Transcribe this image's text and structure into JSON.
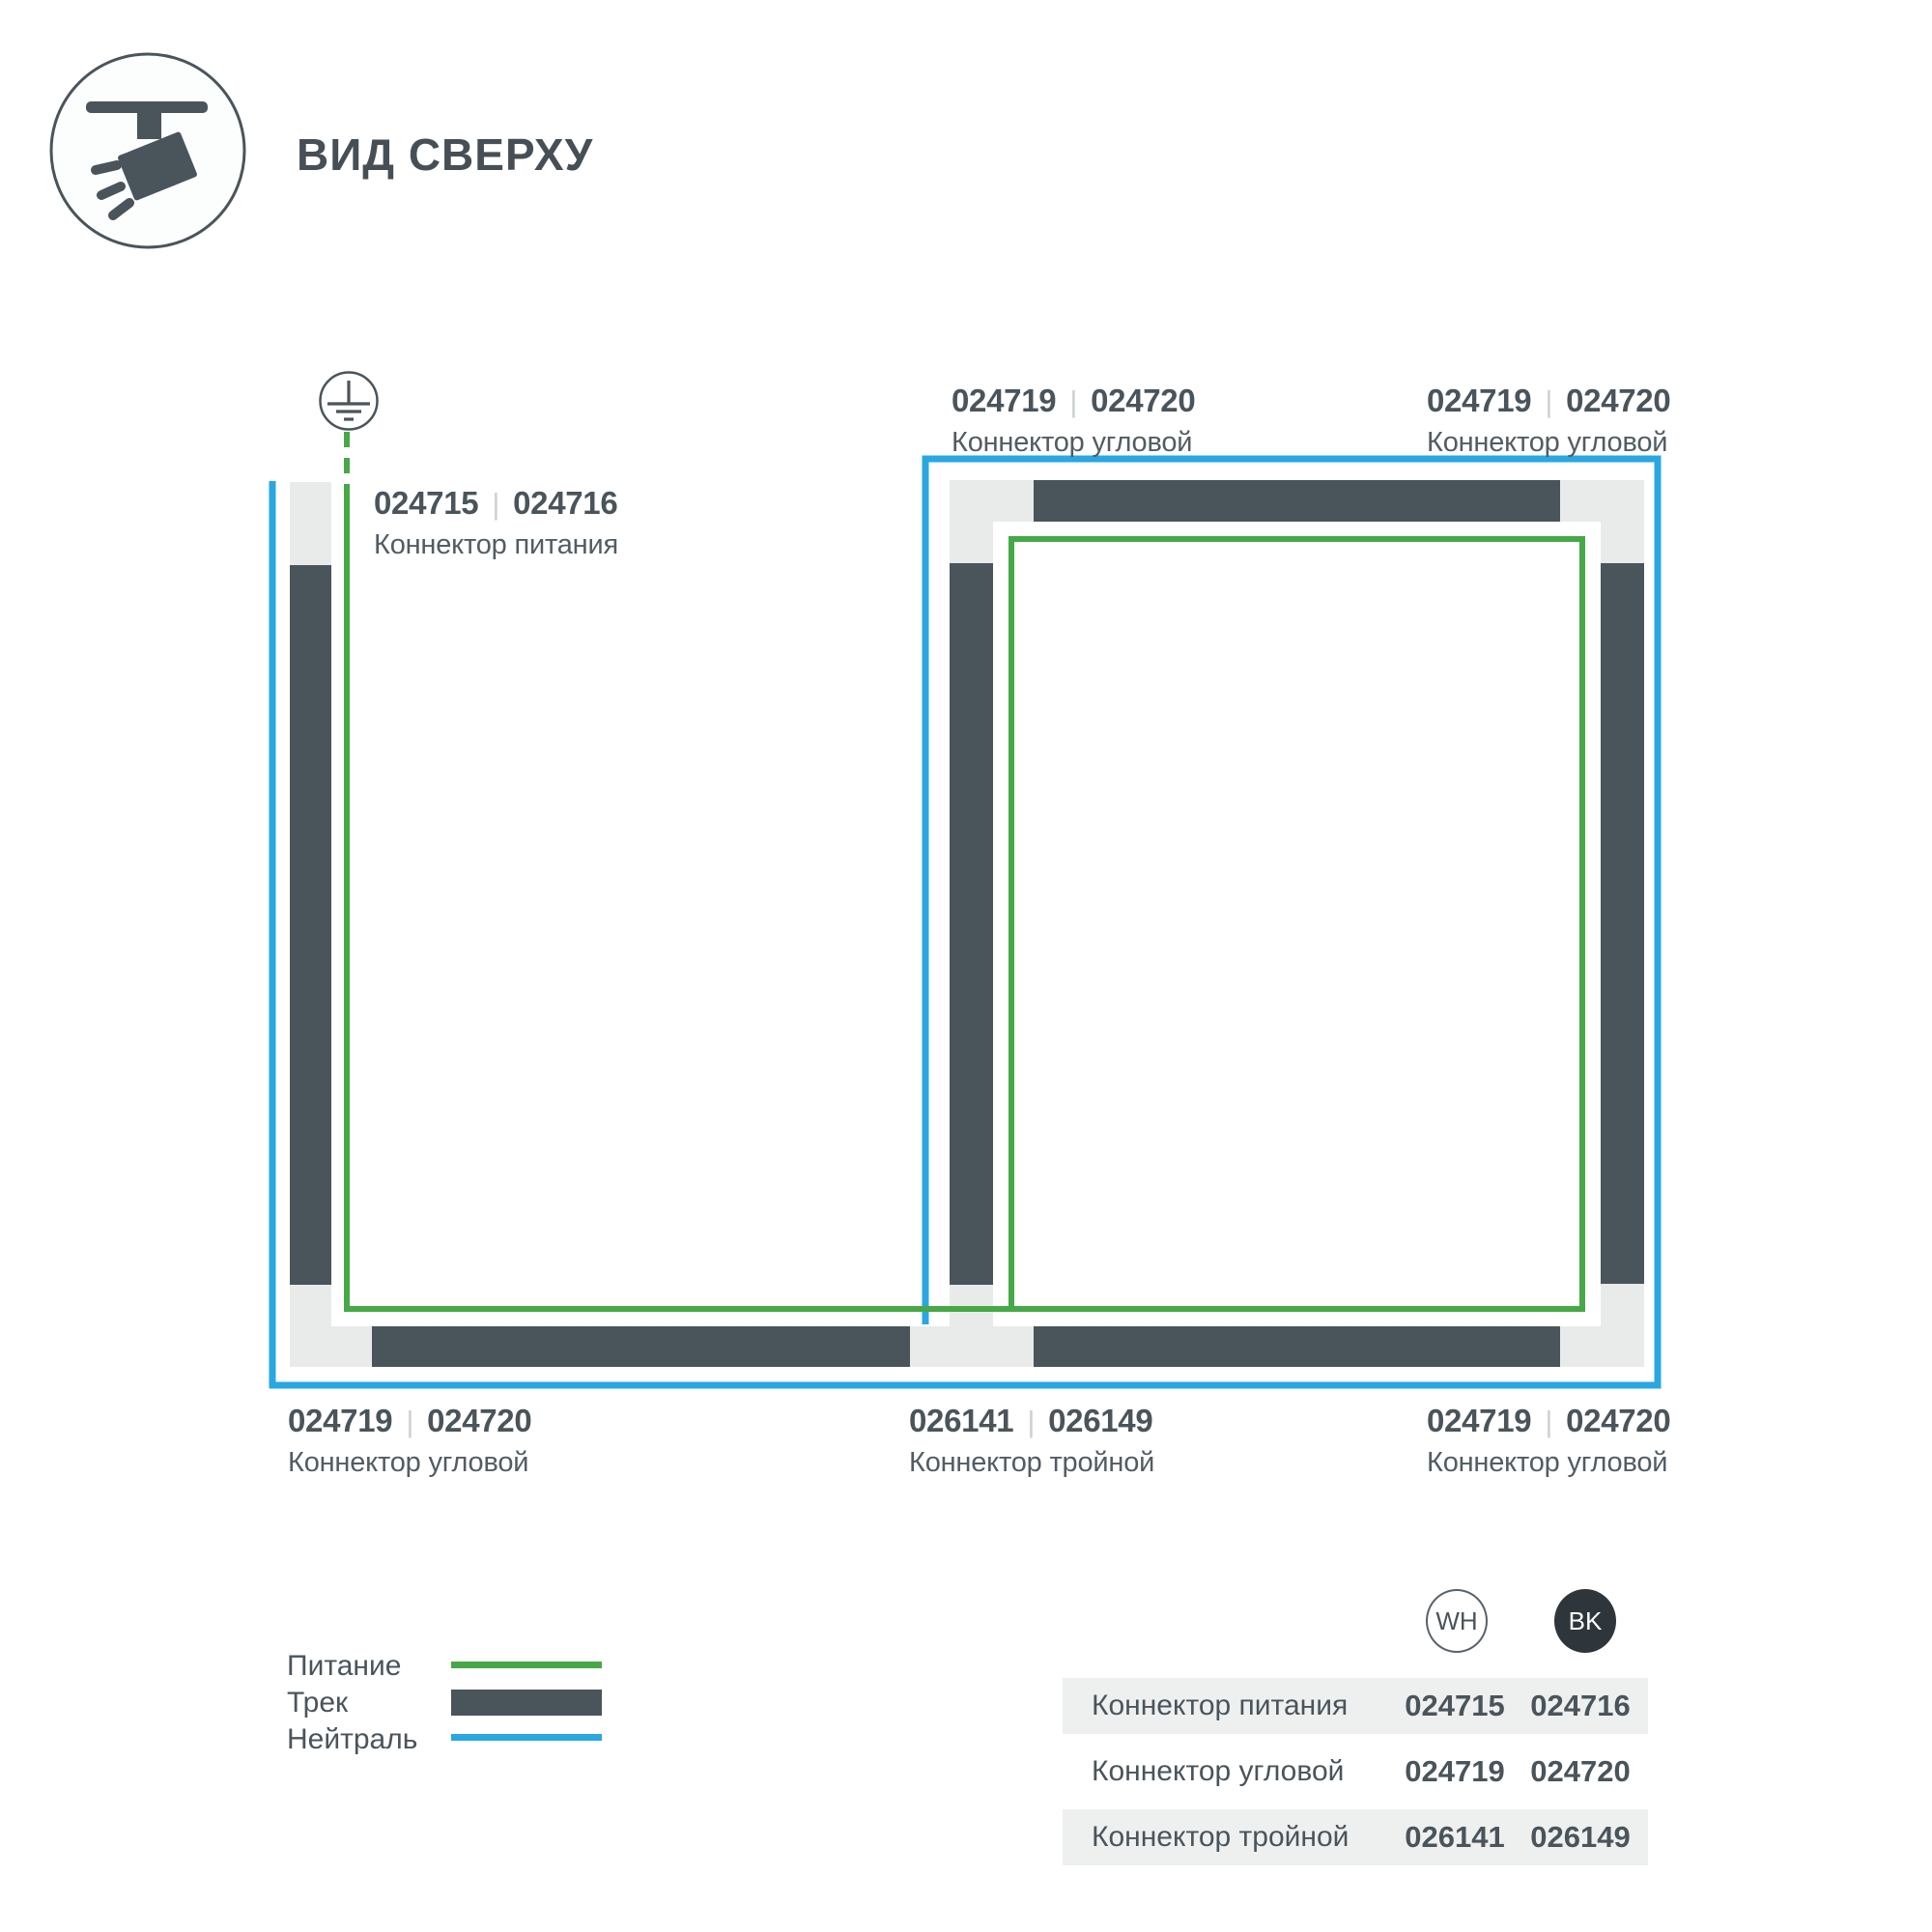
{
  "ui": {
    "code_separator": "|"
  },
  "header": {
    "title": "ВИД СВЕРХУ",
    "icon": "track-spotlight-icon"
  },
  "diagram": {
    "ground_icon": "ground-earth-icon",
    "labels": [
      {
        "codes": [
          "024719",
          "024720"
        ],
        "name": "Коннектор угловой"
      },
      {
        "codes": [
          "024719",
          "024720"
        ],
        "name": "Коннектор угловой"
      },
      {
        "codes": [
          "024715",
          "024716"
        ],
        "name": "Коннектор питания"
      },
      {
        "codes": [
          "024719",
          "024720"
        ],
        "name": "Коннектор угловой"
      },
      {
        "codes": [
          "026141",
          "026149"
        ],
        "name": "Коннектор тройной"
      },
      {
        "codes": [
          "024719",
          "024720"
        ],
        "name": "Коннектор угловой"
      }
    ]
  },
  "legend": {
    "items": [
      {
        "label": "Питание",
        "swatch": "power-line-green"
      },
      {
        "label": "Трек",
        "swatch": "track-bar-dark"
      },
      {
        "label": "Нейтраль",
        "swatch": "neutral-line-blue"
      }
    ]
  },
  "table": {
    "columns": [
      {
        "label": "WH"
      },
      {
        "label": "BK"
      }
    ],
    "rows": [
      {
        "name": "Коннектор питания",
        "wh": "024715",
        "bk": "024716"
      },
      {
        "name": "Коннектор угловой",
        "wh": "024719",
        "bk": "024720"
      },
      {
        "name": "Коннектор тройной",
        "wh": "026141",
        "bk": "026149"
      }
    ]
  },
  "colors": {
    "power_green": "#46a847",
    "neutral_blue": "#29a7e0",
    "track_dark": "#4a545b",
    "track_light": "#e9ebeb",
    "text_dark": "#4a545b",
    "text_medium": "#525c63",
    "code_separator_gray": "#ccd1d3",
    "table_row_bg": "#eef0f0",
    "bk_badge_fill": "#2f363b"
  }
}
